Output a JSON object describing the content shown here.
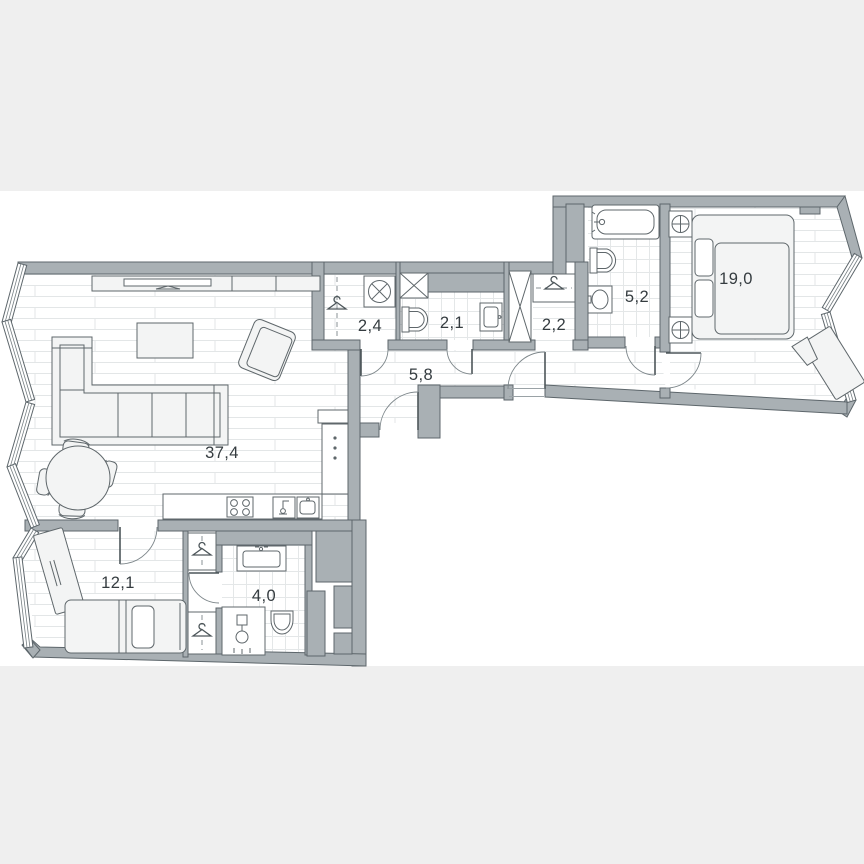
{
  "plan": {
    "type": "apartment-floor-plan",
    "rooms": [
      {
        "id": "living-room-kitchen",
        "area": "37,4"
      },
      {
        "id": "wardrobe-hall",
        "area": "2,4"
      },
      {
        "id": "guest-bathroom",
        "area": "2,1"
      },
      {
        "id": "closet",
        "area": "2,2"
      },
      {
        "id": "hallway",
        "area": "5,8"
      },
      {
        "id": "main-bathroom",
        "area": "5,2"
      },
      {
        "id": "master-bedroom",
        "area": "19,0"
      },
      {
        "id": "second-bedroom",
        "area": "12,1"
      },
      {
        "id": "ensuite-bathroom",
        "area": "4,0"
      }
    ],
    "icons": [
      "bathtub-icon",
      "toilet-icon",
      "sink-icon",
      "shower-icon",
      "washing-machine-icon",
      "hanger-icon",
      "stove-icon",
      "fridge-icon",
      "sofa-icon",
      "armchair-icon",
      "coffee-table-icon",
      "dining-table-icon",
      "tv-console-icon",
      "bed-icon",
      "nightstand-lamp-icon",
      "desk-icon",
      "vent-shaft-icon"
    ],
    "colors": {
      "wall": "#a9b0b4",
      "wall_outline": "#5d666b",
      "background_band": "#efefef",
      "floor_line": "#e3e6e7",
      "label_text": "#353c40"
    }
  }
}
